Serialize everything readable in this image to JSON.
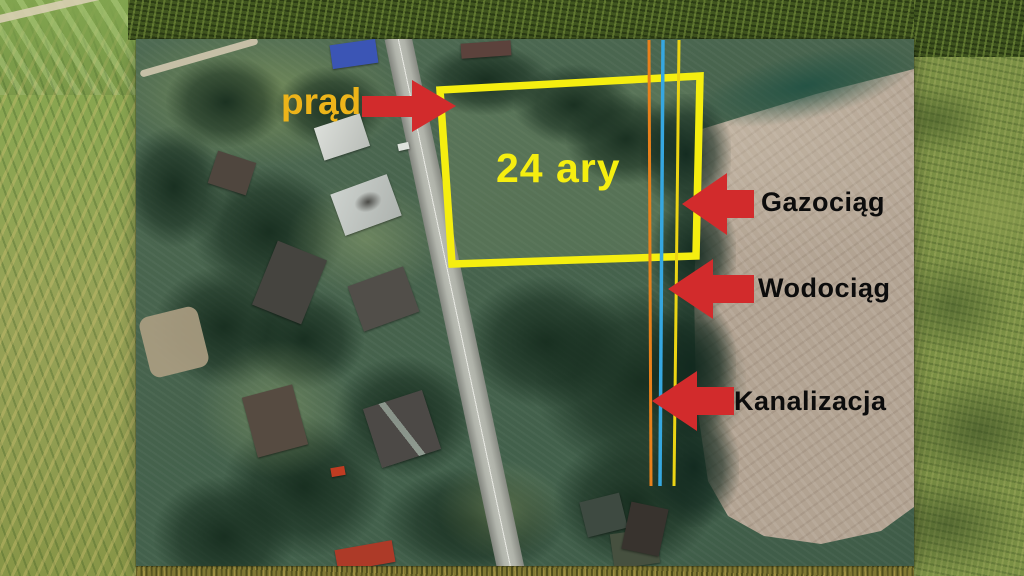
{
  "annotations": {
    "area": "24 ary",
    "electricity": "prąd",
    "gas": "Gazociąg",
    "water": "Wodociąg",
    "sewage": "Kanalizacja"
  },
  "colors": {
    "plot_outline": "#f5ee10",
    "area_text": "#f5ee10",
    "electricity_text": "#edb41a",
    "arrow": "#d22b2c",
    "utility_label_text": "#0c0c0c",
    "line_orange": "#e8811c",
    "line_blue": "#36a7e0",
    "line_yellow": "#ecd414"
  }
}
